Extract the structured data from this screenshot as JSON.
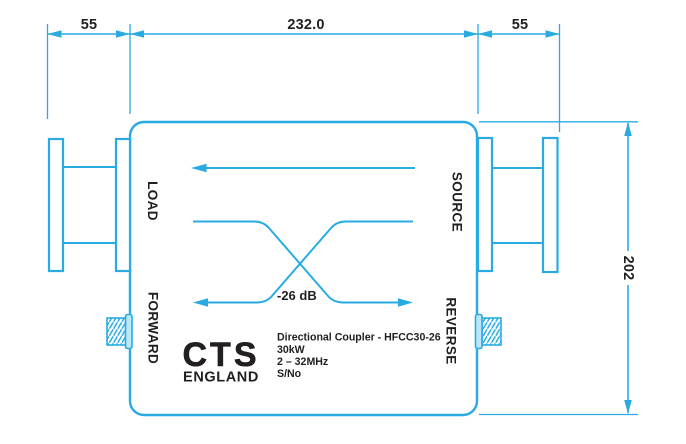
{
  "drawing": {
    "type": "directional-coupler-outline-drawing",
    "dimensions": {
      "left_flange_width": "55",
      "body_width": "232.0",
      "right_flange_width": "55",
      "body_height": "202"
    },
    "ports": {
      "load": "LOAD",
      "source": "SOURCE",
      "forward": "FORWARD",
      "reverse": "REVERSE"
    },
    "coupling_label": "-26 dB",
    "title_block": {
      "line1": "Directional Coupler - HFCC30-26",
      "line2": "30kW",
      "line3": "2 – 32MHz",
      "line4": "S/No"
    },
    "logo": {
      "name": "CTS",
      "country": "ENGLAND"
    },
    "colors": {
      "line": "#29ABE2",
      "text": "#231F20",
      "connector_fill": "#BFE6F7",
      "background": "#FFFFFF"
    }
  }
}
